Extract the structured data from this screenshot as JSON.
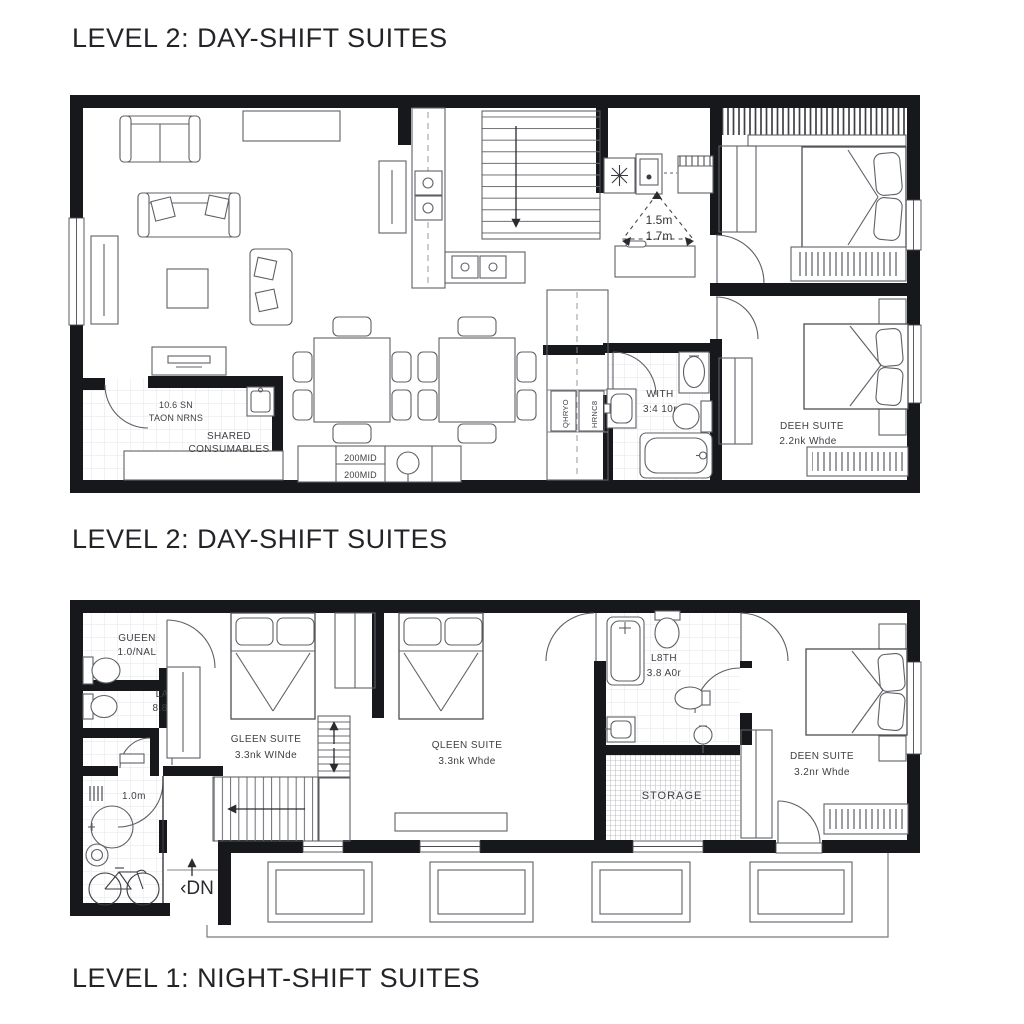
{
  "titles": {
    "t1": "LEVEL 2: DAY-SHIFT SUITES",
    "t2": "LEVEL 2: DAY-SHIFT SUITES",
    "t3": "LEVEL 1: NIGHT-SHIFT SUITES"
  },
  "l2": {
    "shared": {
      "l1": "10.6 SN",
      "l2": "TAON NRNS",
      "l3": "SHARED",
      "l4": "CONSUMABLES"
    },
    "counter": {
      "c1": "200MID",
      "c2": "200MID"
    },
    "pantry": {
      "p1": "QHRYO",
      "p2": "HRNC8"
    },
    "triangle": {
      "a": "1.5m",
      "b": "1.7m"
    },
    "bath": {
      "l1": "WITH",
      "l2": "3:4 10r"
    },
    "suite": {
      "l1": "DEEH SUITE",
      "l2": "2.2nk Whde"
    }
  },
  "l1": {
    "wc1": {
      "l1": "GUEEN",
      "l2": "1.0/NAL"
    },
    "wc2": {
      "l1": "LAGH",
      "l2": "8.8 10m"
    },
    "util": {
      "dim": "1.0m"
    },
    "stair": {
      "dn": "‹DN"
    },
    "s1": {
      "l1": "GLEEN SUITE",
      "l2": "3.3nk WINde"
    },
    "s2": {
      "l1": "QLEEN SUITE",
      "l2": "3.3nk Whde"
    },
    "bath": {
      "l1": "L8TH",
      "l2": "3.8 A0r"
    },
    "storage": {
      "label": "STORAGE"
    },
    "s3": {
      "l1": "DEEN SUITE",
      "l2": "3.2nr Whde"
    }
  },
  "colors": {
    "wall": "#17181b",
    "furniture_line": "#5f6066",
    "label": "#3e3f44",
    "tile": "#e3e4e7",
    "title": "#232428"
  }
}
